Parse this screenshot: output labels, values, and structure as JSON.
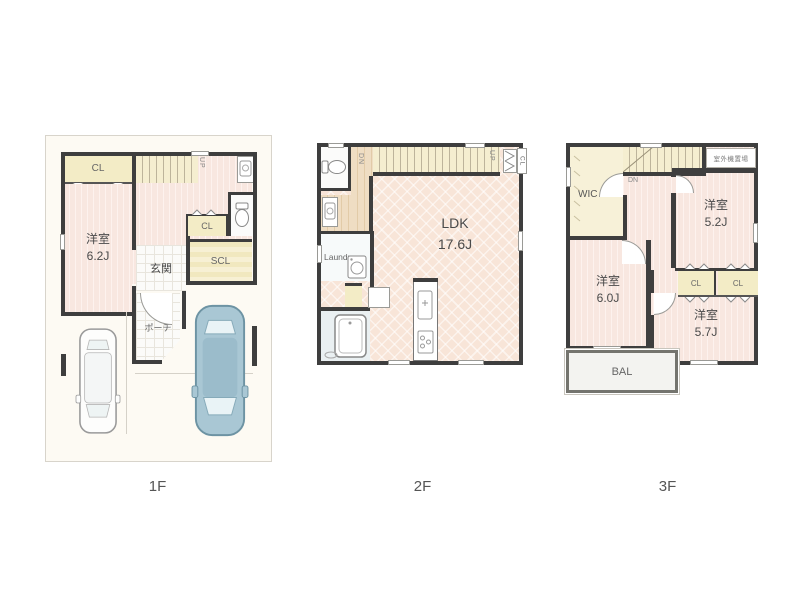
{
  "colors": {
    "wall": "#3e3e3e",
    "floor_pink": "#f8e7e0",
    "floor_pink_stripe": "#fdf2ee",
    "stairs_cream": "#f5eed0",
    "closet_yellow": "#f3ecc6",
    "ldk_peach": "#f8e5d8",
    "wood": "#efddc3",
    "tile_white": "#fbfbf9",
    "bath_blue": "#eaf0f2",
    "lot_bg": "#fdfaf3",
    "car_blue": "#a9c7d4",
    "label_gray": "#555555"
  },
  "floors": [
    {
      "label": "1F",
      "texts": {
        "cl_top": "CL",
        "room_name": "洋室",
        "room_size": "6.2J",
        "up": "UP",
        "genkan": "玄関",
        "cl_mid": "CL",
        "scl": "SCL",
        "porch": "ポーチ"
      }
    },
    {
      "label": "2F",
      "texts": {
        "dn": "DN",
        "up": "UP",
        "cl": "CL",
        "ldk_name": "LDK",
        "ldk_size": "17.6J",
        "laundry": "Laundry"
      }
    },
    {
      "label": "3F",
      "texts": {
        "wic": "WIC",
        "dn": "DN",
        "outdoor_unit": "室外機置場",
        "room1_name": "洋室",
        "room1_size": "5.2J",
        "room2_name": "洋室",
        "room2_size": "6.0J",
        "cl1": "CL",
        "cl2": "CL",
        "room3_name": "洋室",
        "room3_size": "5.7J",
        "bal": "BAL"
      }
    }
  ]
}
